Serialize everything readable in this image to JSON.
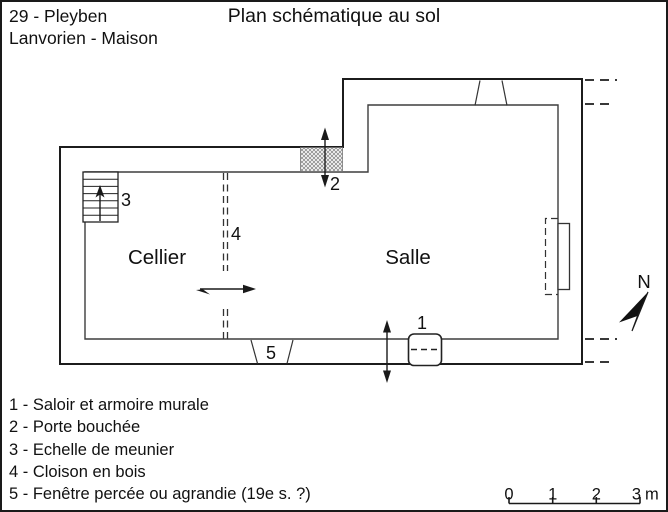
{
  "header": {
    "ref_line1": "29 - Pleyben",
    "ref_line2": "Lanvorien - Maison",
    "title": "Plan schématique au sol"
  },
  "plan": {
    "rooms": {
      "cellier": "Cellier",
      "salle": "Salle"
    },
    "markers": {
      "saloir": "1",
      "porte_bouchee": "2",
      "echelle": "3",
      "cloison": "4",
      "fenetre": "5"
    },
    "compass_label": "N"
  },
  "legend": {
    "items": [
      "1 - Saloir et armoire murale",
      "2 - Porte bouchée",
      "3 - Echelle de meunier",
      "4 - Cloison en bois",
      "5 - Fenêtre percée ou agrandie (19e s. ?)"
    ]
  },
  "scale_bar": {
    "tick_labels": [
      "0",
      "1",
      "2",
      "3"
    ],
    "unit": "m"
  },
  "colors": {
    "ink": "#1a1a1a",
    "paper": "#ffffff"
  }
}
